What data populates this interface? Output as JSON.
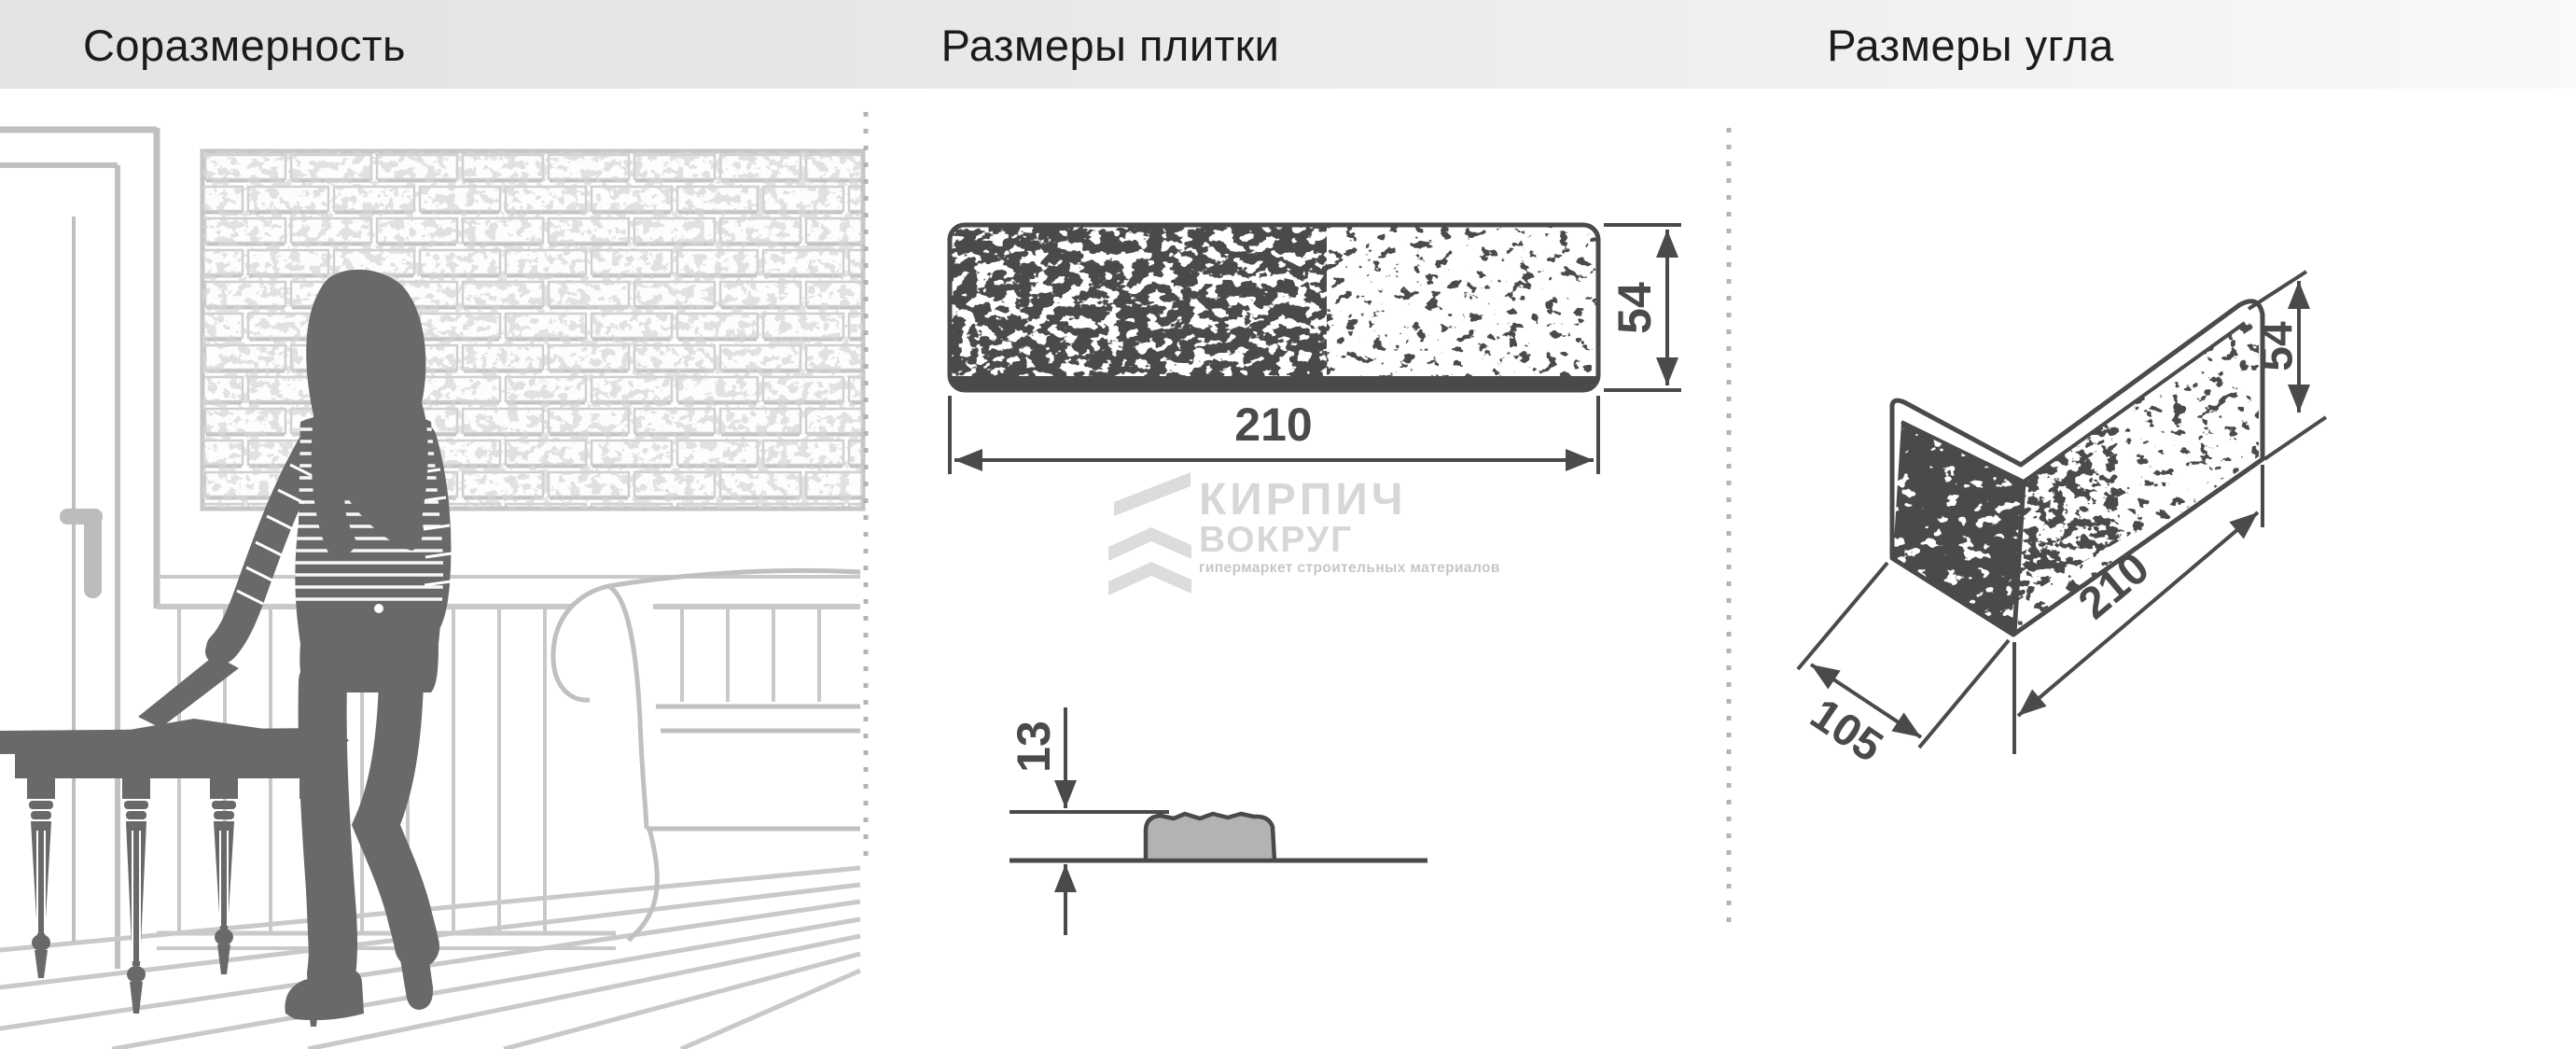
{
  "header": {
    "sections": [
      {
        "title": "Соразмерность"
      },
      {
        "title": "Размеры плитки"
      },
      {
        "title": "Размеры угла"
      }
    ]
  },
  "tile_panel": {
    "width_mm": "210",
    "height_mm": "54",
    "thickness_mm": "13"
  },
  "corner_panel": {
    "length_mm": "210",
    "depth_mm": "105",
    "height_mm": "54"
  },
  "watermark": {
    "brand_line1": "КИРПИЧ",
    "brand_line2": "ВОКРУГ",
    "tagline": "гипермаркет строительных материалов"
  },
  "colors": {
    "header_bg": "#e6e6e6",
    "header_text": "#1b1b1b",
    "drawing_dark": "#4a4a4a",
    "scene_light_gray": "#c0c0c0",
    "silhouette_gray": "#696969",
    "profile_fill": "#b3b3b3",
    "watermark_gray": "#d7d7d7",
    "divider_dot": "#b4b4b4"
  }
}
